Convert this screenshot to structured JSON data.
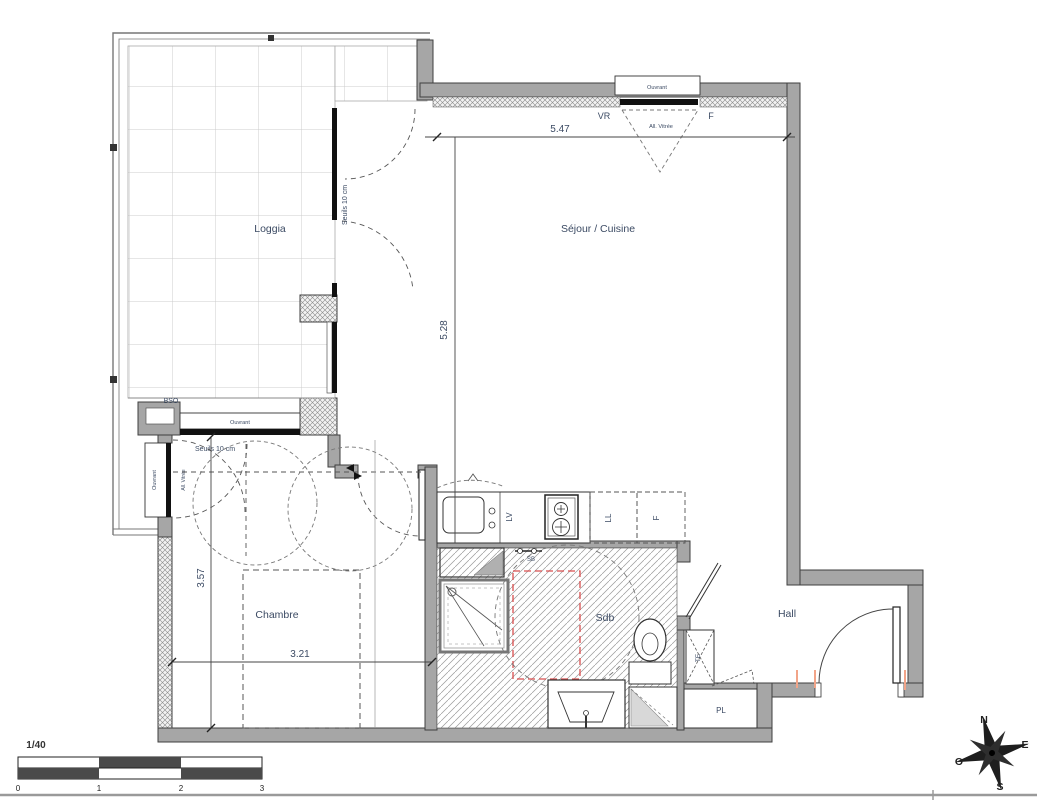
{
  "plan": {
    "rooms": {
      "loggia": "Loggia",
      "sejour": "Séjour / Cuisine",
      "chambre": "Chambre",
      "sdb": "Sdb",
      "hall": "Hall",
      "placard": "PL",
      "tableau_electrique": "TE"
    },
    "dimensions": {
      "sejour_width": "5.47",
      "sejour_height": "5.28",
      "chambre_height": "3.57",
      "chambre_width": "3.21"
    },
    "window_labels": {
      "vr": "VR",
      "fenetre": "F",
      "allege_vitree": "All. Vitrée",
      "ouvrant": "Ouvrant",
      "bso": "BSO",
      "seuils": "Seuils 10 cm"
    },
    "kitchen": {
      "lv": "LV",
      "ll": "LL",
      "frigo": "F",
      "sb": "SB"
    },
    "scale": {
      "ratio": "1/40",
      "ticks": [
        "0",
        "1",
        "2",
        "3"
      ]
    },
    "compass": {
      "north": "N",
      "east": "E",
      "south": "S",
      "west": "O"
    }
  },
  "colors": {
    "wall": "#a6a6a6",
    "glazing": "#111111",
    "label_text": "#3b4a63",
    "red_dashed": "#d94f4f",
    "jamb_tick_orange": "#f2a488"
  }
}
